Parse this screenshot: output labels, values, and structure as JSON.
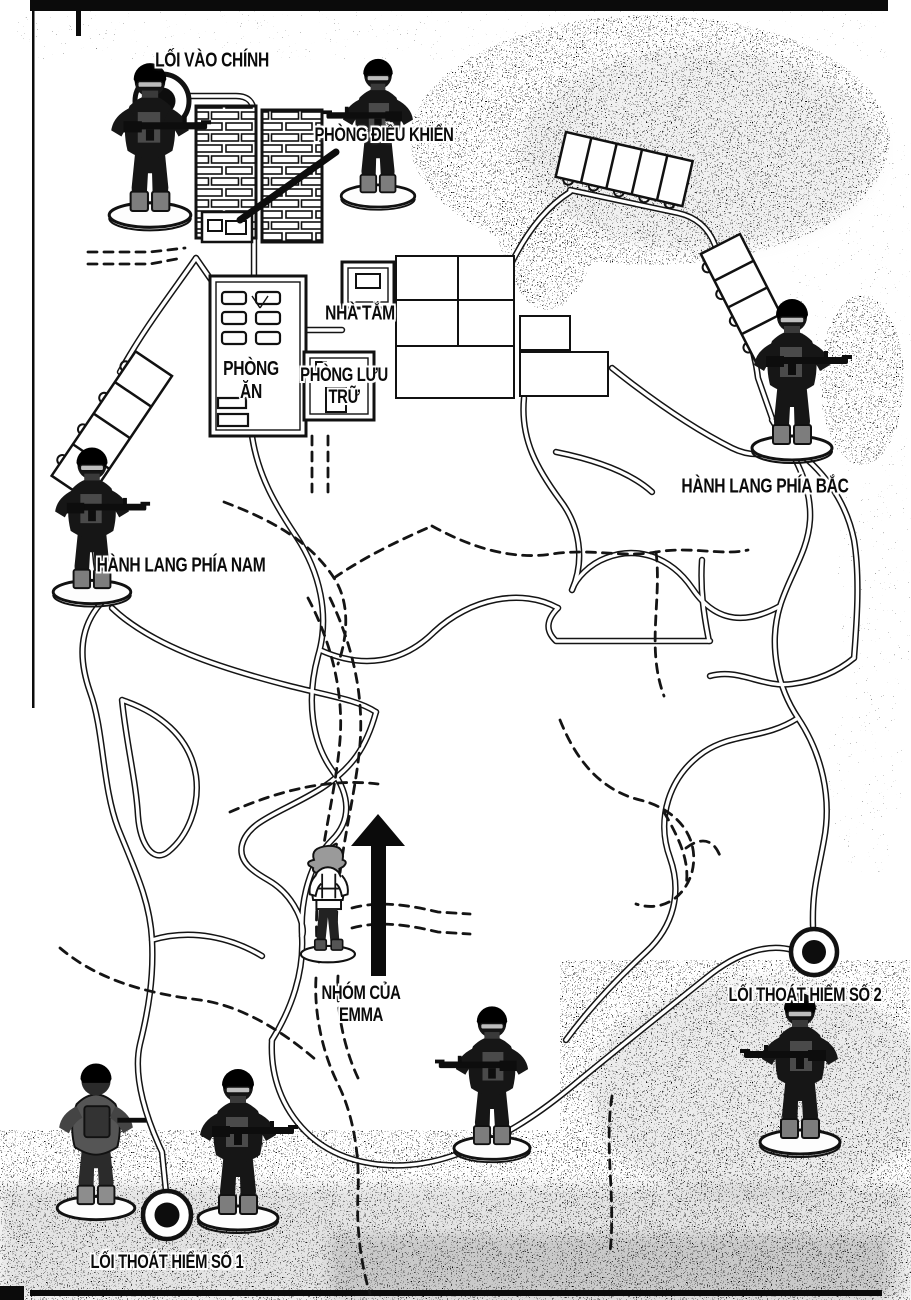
{
  "labels": {
    "main_entrance": "LỐI VÀO CHÍNH",
    "control_room": "PHÒNG ĐIỀU KHIỂN",
    "bathroom": "NHÀ TẮM",
    "dining_room": [
      "PHÒNG",
      "ĂN"
    ],
    "storage_room": [
      "PHÒNG LƯU",
      "TRỮ"
    ],
    "north_corridor": "HÀNH LANG PHÍA BẮC",
    "south_corridor": "HÀNH LANG PHÍA NAM",
    "emma_group": [
      "NHÓM CỦA",
      "EMMA"
    ],
    "exit_2": "LỐI THOÁT HIỂM SỐ 2",
    "exit_1": "LỐI THOÁT HIỂM SỐ 1"
  },
  "colors": {
    "ink": "#111111",
    "paper": "#ffffff",
    "screentone_gray": "#a8a8a8",
    "boot_gray": "#7d7d7d"
  },
  "icons": {
    "soldier": "toy-soldier-figurine",
    "soldier_back": "toy-soldier-figurine-back-view",
    "emma": "emma-figurine",
    "hatch_ring": "round-hatch-marker",
    "arrow": "up-direction-arrow"
  }
}
